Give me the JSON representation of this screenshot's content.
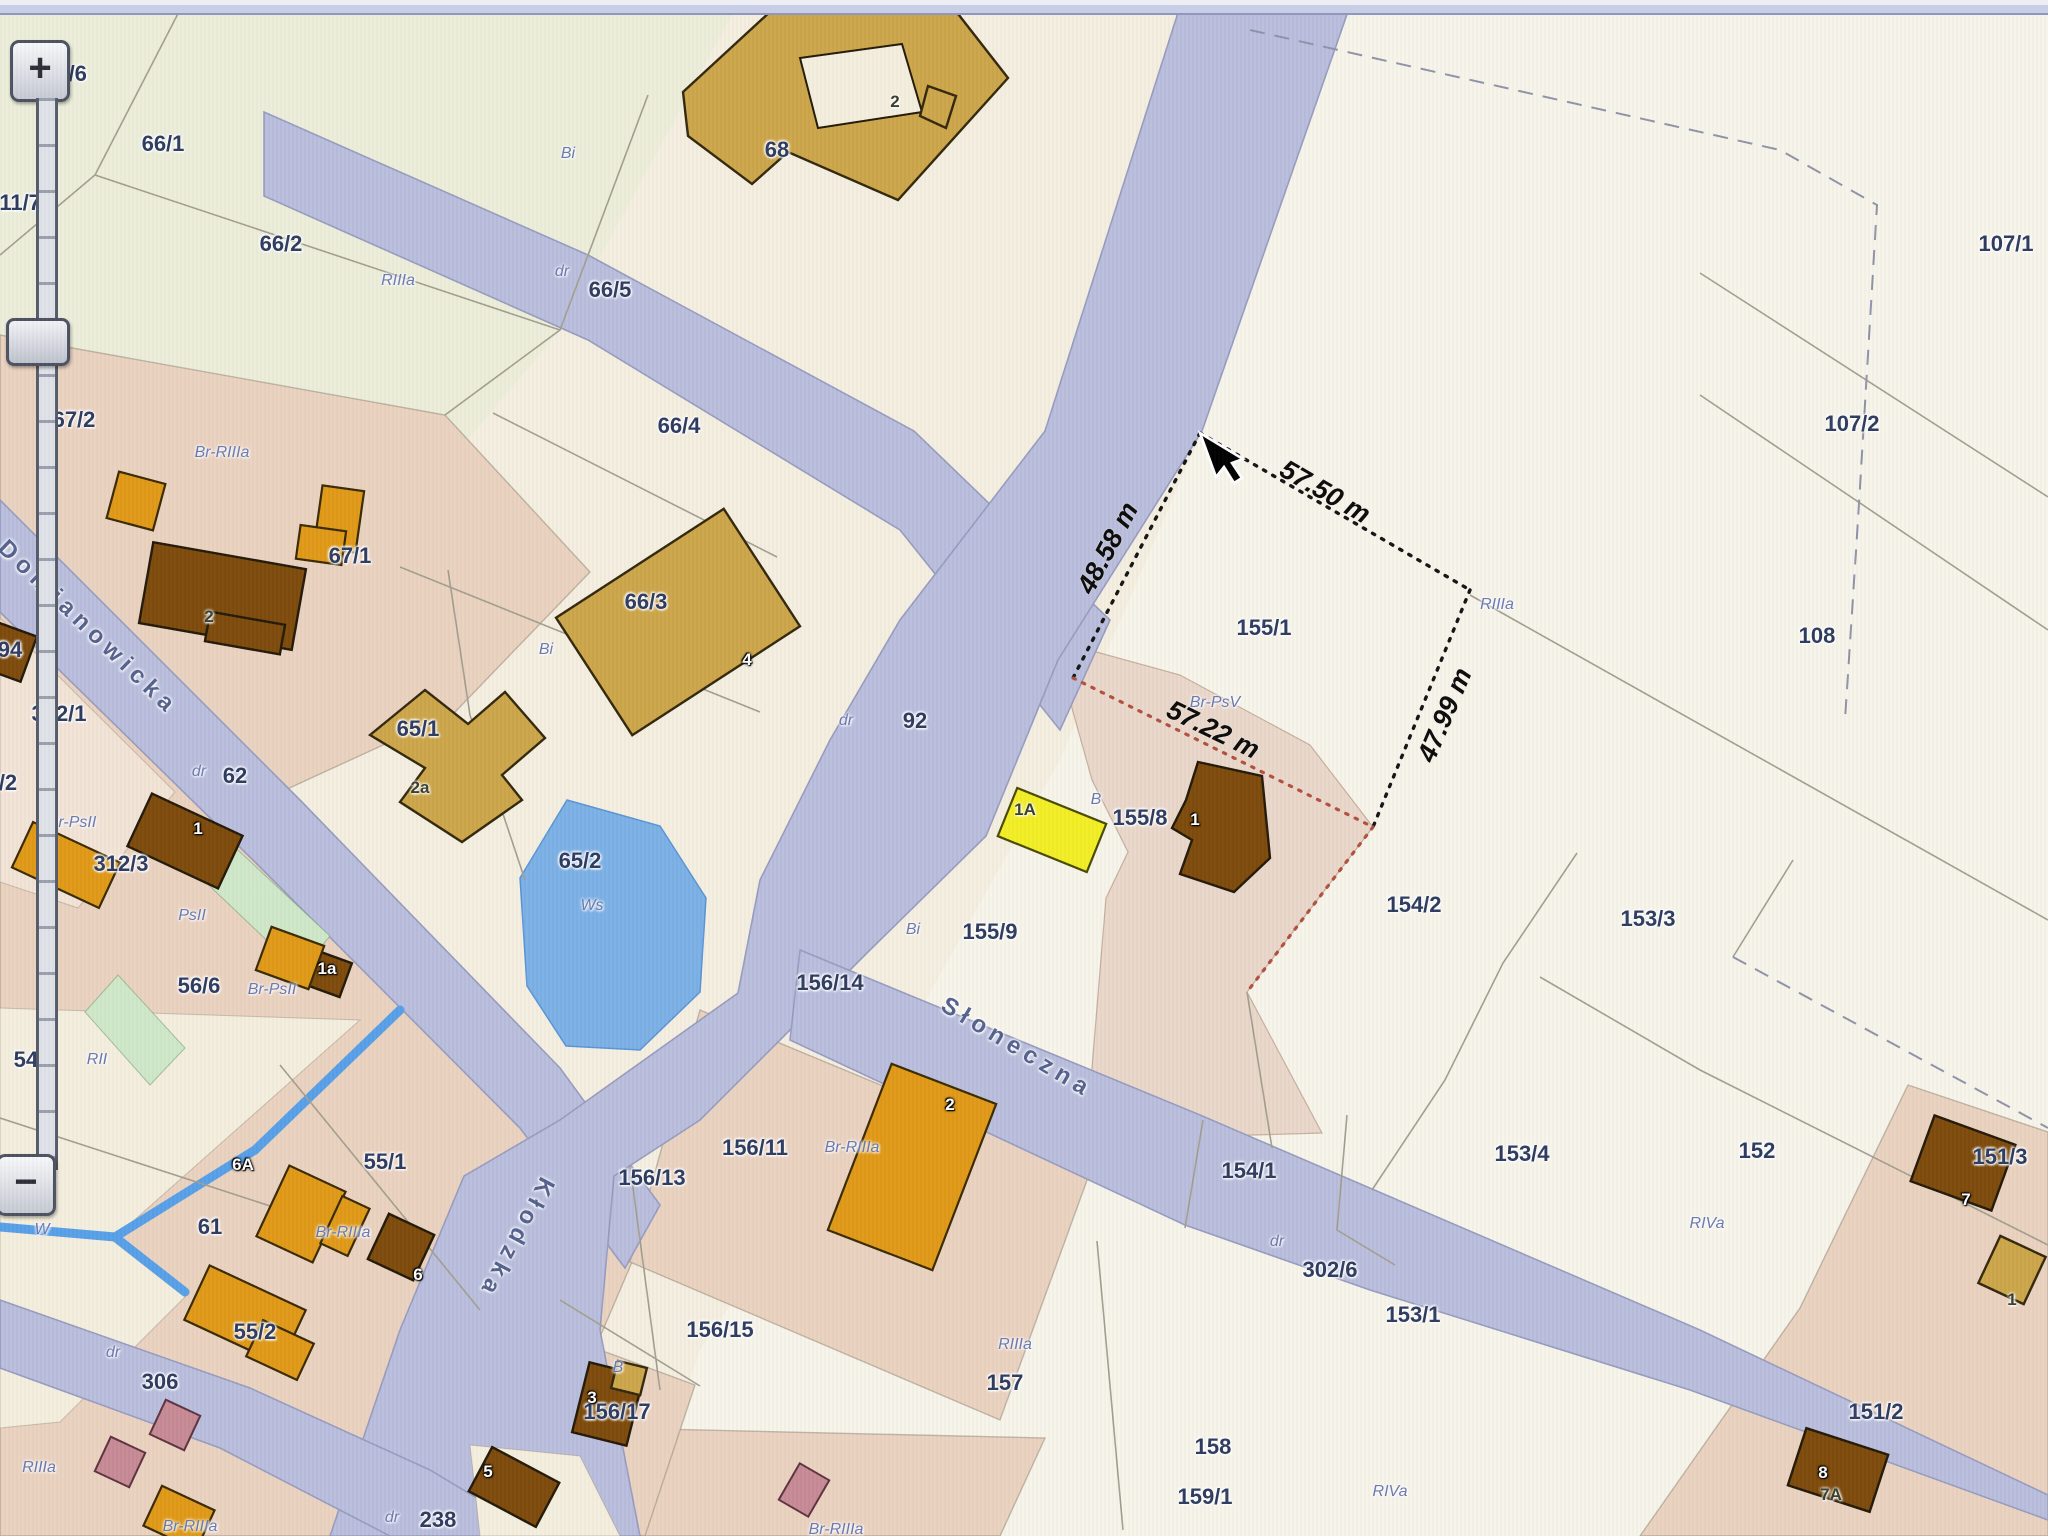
{
  "screen": {
    "width": 2048,
    "height": 1536
  },
  "app": {
    "description": "cadastral parcel map viewer with measurement overlay"
  },
  "colors": {
    "road": "#b9bedc",
    "roadEdge": "#989dc0",
    "water": "#7cb1e6",
    "stream": "#58a0e8",
    "salmon": "#ebd2c0",
    "pinkMeasured": "#ead7ca",
    "palePink": "#f2e3d6",
    "cream2": "#f4eedd",
    "pale": "#f7f4ea",
    "greenish": "#eceeda",
    "green": "#cfe8c8",
    "brown": "#7d4b0b",
    "orange": "#e09a18",
    "tan": "#cda64b",
    "yellow": "#f2ee25",
    "mauve": "#c78b96",
    "parcelText": "#2e3c60",
    "soilText": "#6b7ab0",
    "measureText": "#0b0b0b",
    "dottedBlack": "#141414",
    "dottedRed": "#b2503f"
  },
  "zoom_control": {
    "plus_label": "+",
    "minus_label": "−"
  },
  "streets": [
    {
      "name": "Domianowicka",
      "x": 88,
      "y": 628,
      "rotate": 44
    },
    {
      "name": "Kłodzka",
      "x": 516,
      "y": 1238,
      "rotate": 118
    },
    {
      "name": "Słoneczna",
      "x": 1017,
      "y": 1048,
      "rotate": 31
    }
  ],
  "measurements": [
    {
      "text": "48.58 m",
      "x": 1108,
      "y": 548,
      "rotate": -62
    },
    {
      "text": "57.50 m",
      "x": 1325,
      "y": 492,
      "rotate": 30
    },
    {
      "text": "57.22 m",
      "x": 1213,
      "y": 730,
      "rotate": 26
    },
    {
      "text": "47.99 m",
      "x": 1445,
      "y": 715,
      "rotate": -67
    }
  ],
  "parcel_labels": [
    {
      "t": "311/6",
      "x": 60,
      "y": 74
    },
    {
      "t": "311/7",
      "x": 14,
      "y": 203
    },
    {
      "t": "66/1",
      "x": 163,
      "y": 144
    },
    {
      "t": "66/2",
      "x": 281,
      "y": 244
    },
    {
      "t": "66/5",
      "x": 610,
      "y": 290
    },
    {
      "t": "66/4",
      "x": 679,
      "y": 426
    },
    {
      "t": "67/2",
      "x": 74,
      "y": 420
    },
    {
      "t": "67/1",
      "x": 350,
      "y": 556
    },
    {
      "t": "66/3",
      "x": 646,
      "y": 602
    },
    {
      "t": "65/1",
      "x": 418,
      "y": 729
    },
    {
      "t": "65/2",
      "x": 580,
      "y": 861
    },
    {
      "t": "92",
      "x": 915,
      "y": 721
    },
    {
      "t": "68",
      "x": 777,
      "y": 150
    },
    {
      "t": "312/1",
      "x": 59,
      "y": 714
    },
    {
      "t": "62",
      "x": 235,
      "y": 776
    },
    {
      "t": "312/3",
      "x": 121,
      "y": 864
    },
    {
      "t": "56/6",
      "x": 199,
      "y": 986
    },
    {
      "t": "94",
      "x": 10,
      "y": 650
    },
    {
      "t": "/2",
      "x": 8,
      "y": 783
    },
    {
      "t": "54/1",
      "x": 35,
      "y": 1060
    },
    {
      "t": "54/2",
      "x": 35,
      "y": 1173
    },
    {
      "t": "55/1",
      "x": 385,
      "y": 1162
    },
    {
      "t": "61",
      "x": 210,
      "y": 1227
    },
    {
      "t": "55/2",
      "x": 255,
      "y": 1332
    },
    {
      "t": "306",
      "x": 160,
      "y": 1382
    },
    {
      "t": "238",
      "x": 438,
      "y": 1520
    },
    {
      "t": "107/1",
      "x": 2006,
      "y": 244
    },
    {
      "t": "107/2",
      "x": 1852,
      "y": 424
    },
    {
      "t": "108",
      "x": 1817,
      "y": 636
    },
    {
      "t": "155/1",
      "x": 1264,
      "y": 628
    },
    {
      "t": "155/8",
      "x": 1140,
      "y": 818
    },
    {
      "t": "155/9",
      "x": 990,
      "y": 932
    },
    {
      "t": "156/14",
      "x": 830,
      "y": 983
    },
    {
      "t": "156/11",
      "x": 755,
      "y": 1148
    },
    {
      "t": "156/13",
      "x": 652,
      "y": 1178
    },
    {
      "t": "156/15",
      "x": 720,
      "y": 1330
    },
    {
      "t": "156/17",
      "x": 617,
      "y": 1412
    },
    {
      "t": "157",
      "x": 1005,
      "y": 1383
    },
    {
      "t": "158",
      "x": 1213,
      "y": 1447
    },
    {
      "t": "159/1",
      "x": 1205,
      "y": 1497
    },
    {
      "t": "154/2",
      "x": 1414,
      "y": 905
    },
    {
      "t": "154/1",
      "x": 1249,
      "y": 1171
    },
    {
      "t": "153/3",
      "x": 1648,
      "y": 919
    },
    {
      "t": "153/4",
      "x": 1522,
      "y": 1154
    },
    {
      "t": "153/1",
      "x": 1413,
      "y": 1315
    },
    {
      "t": "152",
      "x": 1757,
      "y": 1151
    },
    {
      "t": "151/3",
      "x": 2000,
      "y": 1157
    },
    {
      "t": "151/2",
      "x": 1876,
      "y": 1412
    },
    {
      "t": "302/6",
      "x": 1330,
      "y": 1270
    }
  ],
  "soil_labels": [
    {
      "t": "Bi",
      "x": 568,
      "y": 154
    },
    {
      "t": "RIIIa",
      "x": 398,
      "y": 281
    },
    {
      "t": "dr",
      "x": 562,
      "y": 272
    },
    {
      "t": "dr",
      "x": 846,
      "y": 721
    },
    {
      "t": "dr",
      "x": 199,
      "y": 772
    },
    {
      "t": "Bi",
      "x": 546,
      "y": 650
    },
    {
      "t": "Br-RIIIa",
      "x": 222,
      "y": 453
    },
    {
      "t": "Br-PsII",
      "x": 72,
      "y": 823
    },
    {
      "t": "PsII",
      "x": 192,
      "y": 916
    },
    {
      "t": "Br-PsII",
      "x": 272,
      "y": 990
    },
    {
      "t": "RII",
      "x": 97,
      "y": 1060
    },
    {
      "t": "Ws",
      "x": 592,
      "y": 906
    },
    {
      "t": "W",
      "x": 42,
      "y": 1230
    },
    {
      "t": "RIIIa",
      "x": 1497,
      "y": 605
    },
    {
      "t": "Br-PsV",
      "x": 1215,
      "y": 703
    },
    {
      "t": "B",
      "x": 1096,
      "y": 800
    },
    {
      "t": "Bi",
      "x": 913,
      "y": 930
    },
    {
      "t": "Br-RIIIa",
      "x": 852,
      "y": 1148
    },
    {
      "t": "Br-RIIIa",
      "x": 343,
      "y": 1233
    },
    {
      "t": "Br-RIIIa",
      "x": 190,
      "y": 1527
    },
    {
      "t": "RIIIa",
      "x": 39,
      "y": 1468
    },
    {
      "t": "RIIIa",
      "x": 1015,
      "y": 1345
    },
    {
      "t": "RIVa",
      "x": 1390,
      "y": 1492
    },
    {
      "t": "RIVa",
      "x": 1707,
      "y": 1224
    },
    {
      "t": "dr",
      "x": 1277,
      "y": 1242
    },
    {
      "t": "dr",
      "x": 113,
      "y": 1353
    },
    {
      "t": "dr",
      "x": 392,
      "y": 1518
    },
    {
      "t": "B",
      "x": 618,
      "y": 1368
    },
    {
      "t": "Br-RIIIa",
      "x": 836,
      "y": 1530
    }
  ],
  "building_labels": [
    {
      "t": "2",
      "s": "dark",
      "x": 895,
      "y": 102
    },
    {
      "t": "2",
      "s": "dark",
      "x": 209,
      "y": 617
    },
    {
      "t": "4",
      "s": "light",
      "x": 747,
      "y": 660
    },
    {
      "t": "2a",
      "s": "dark",
      "x": 420,
      "y": 788
    },
    {
      "t": "1",
      "s": "light",
      "x": 198,
      "y": 829
    },
    {
      "t": "1a",
      "s": "light",
      "x": 327,
      "y": 969
    },
    {
      "t": "6A",
      "s": "light",
      "x": 243,
      "y": 1165
    },
    {
      "t": "6",
      "s": "light",
      "x": 418,
      "y": 1275
    },
    {
      "t": "5",
      "s": "light",
      "x": 488,
      "y": 1472
    },
    {
      "t": "1A",
      "s": "dark",
      "x": 1025,
      "y": 810
    },
    {
      "t": "1",
      "s": "light",
      "x": 1195,
      "y": 820
    },
    {
      "t": "2",
      "s": "light",
      "x": 950,
      "y": 1105
    },
    {
      "t": "3",
      "s": "light",
      "x": 592,
      "y": 1398
    },
    {
      "t": "8",
      "s": "light",
      "x": 1823,
      "y": 1473
    },
    {
      "t": "7A",
      "s": "dark",
      "x": 1831,
      "y": 1495
    },
    {
      "t": "7",
      "s": "light",
      "x": 1966,
      "y": 1200
    },
    {
      "t": "1",
      "s": "dark",
      "x": 2012,
      "y": 1300
    }
  ],
  "cursor": {
    "x": 1200,
    "y": 433
  }
}
